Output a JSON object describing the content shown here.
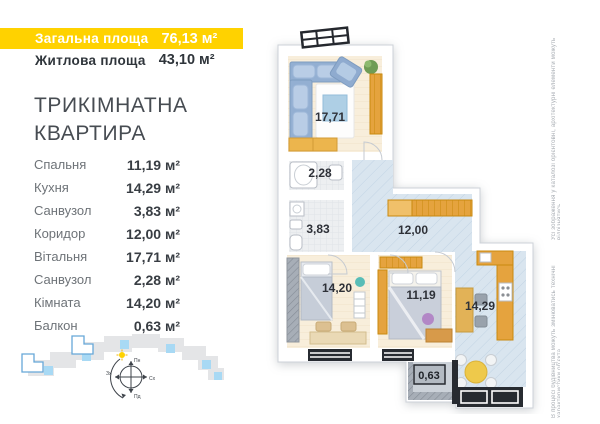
{
  "header": {
    "total_label": "Загальна площа",
    "total_value": "76,13 м²",
    "living_label": "Житлова площа",
    "living_value": "43,10 м²"
  },
  "title": {
    "line1": "ТРИКІМНАТНА",
    "line2": "КВАРТИРА"
  },
  "room_list": {
    "items": [
      {
        "name": "Спальня",
        "area": "11,19 м²"
      },
      {
        "name": "Кухня",
        "area": "14,29 м²"
      },
      {
        "name": "Санвузол",
        "area": "3,83 м²"
      },
      {
        "name": "Коридор",
        "area": "12,00 м²"
      },
      {
        "name": "Вітальня",
        "area": "17,71 м²"
      },
      {
        "name": "Санвузол",
        "area": "2,28 м²"
      },
      {
        "name": "Кімната",
        "area": "14,20 м²"
      },
      {
        "name": "Балкон",
        "area": "0,63 м²"
      }
    ]
  },
  "plan": {
    "labels": {
      "living": "17,71",
      "bath_top": "2,28",
      "bath_mid": "3,83",
      "hall": "12,00",
      "bedroom_left": "14,20",
      "bedroom_mid": "11,19",
      "kitchen": "14,29",
      "balcony": "0,63"
    }
  },
  "compass": {
    "north": "Пн",
    "south": "Пд",
    "east": "Сх",
    "west": "Зх"
  },
  "disclaimer": {
    "top": "Усі зображення у каталозі орієнтовні, архітектурні елементи можуть відрізнятись",
    "bottom": "В процесі будівництва можуть змінюватись технічні характеристики об'єкта"
  },
  "colors": {
    "accent": "#ffd200",
    "floor_warm": "#f8eedb",
    "floor_blue": "#d9e5ef",
    "furniture_orange": "#e5a33e",
    "sofa_blue": "#93afd2"
  }
}
